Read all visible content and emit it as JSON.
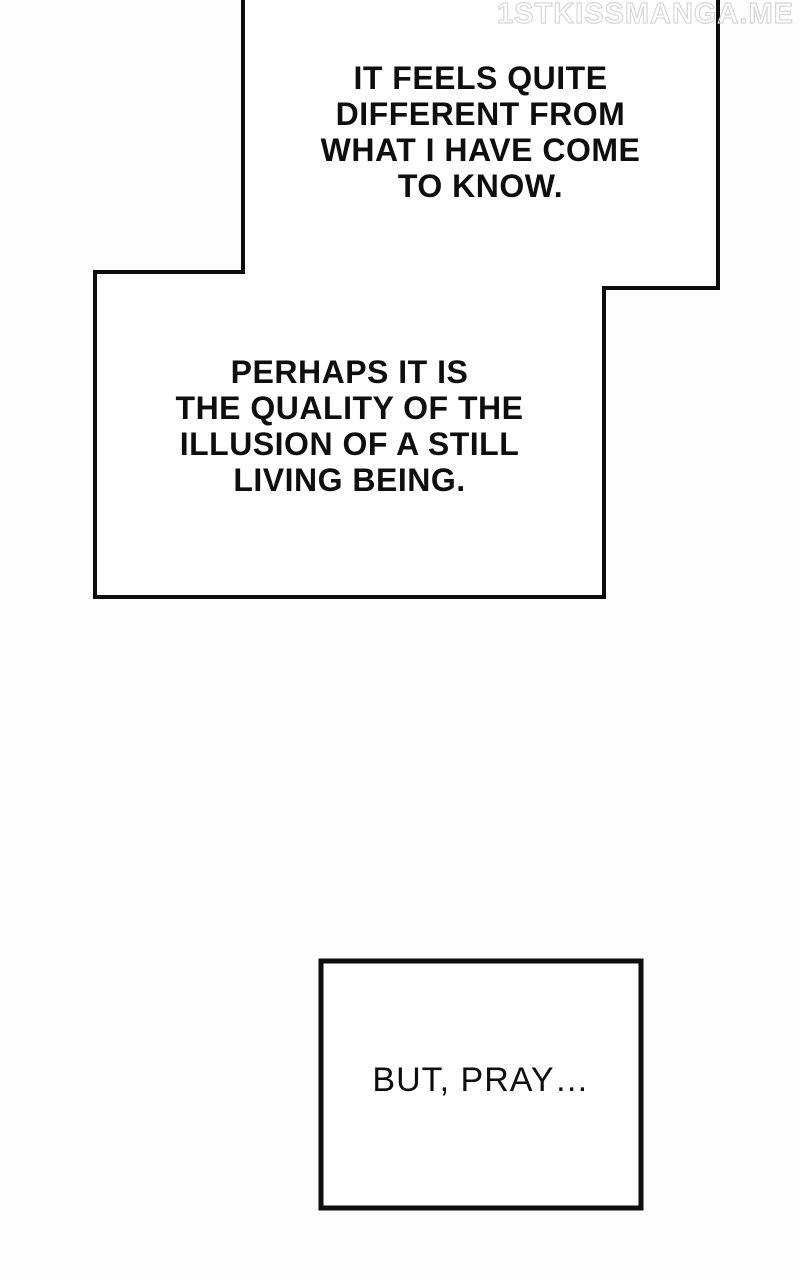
{
  "page": {
    "watermark": "1STKISSMANGA.ME",
    "bubbles": [
      {
        "id": "upper-speech-bubble",
        "text": "IT FEELS QUITE\nDIFFERENT FROM\nWHAT I HAVE COME\nTO KNOW."
      },
      {
        "id": "lower-speech-bubble",
        "text": "PERHAPS IT IS\nTHE QUALITY OF THE\nILLUSION OF A STILL\nLIVING BEING."
      },
      {
        "id": "bottom-speech-box",
        "text": "BUT, PRAY…"
      }
    ],
    "colors": {
      "ink": "#0d0d0d",
      "paper": "#ffffff",
      "background": "#fdfdfd",
      "watermark_outline": "#d7d7d7"
    }
  }
}
